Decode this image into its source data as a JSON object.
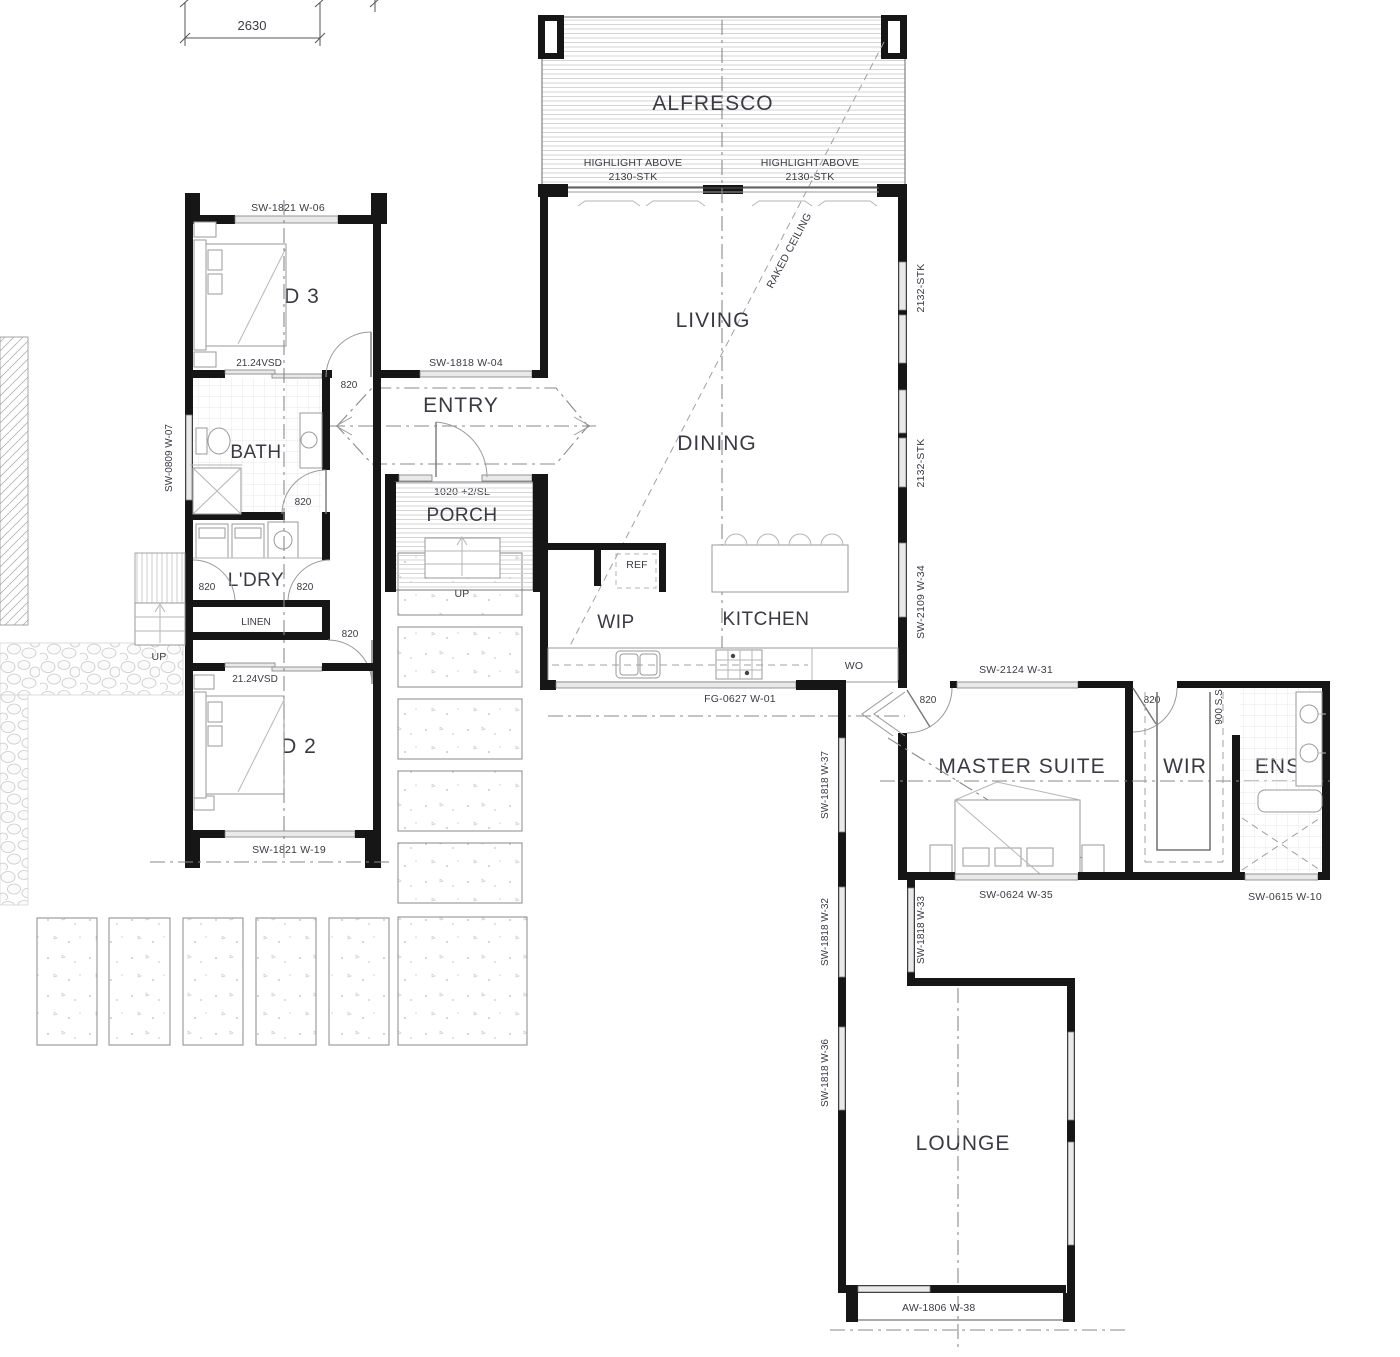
{
  "plan": {
    "dimension_top": "2630",
    "rooms": {
      "alfresco": "ALFRESCO",
      "living": "LIVING",
      "dining": "DINING",
      "kitchen": "KITCHEN",
      "wip": "WIP",
      "entry": "ENTRY",
      "porch": "PORCH",
      "bed3": "BED 3",
      "bath": "BATH",
      "ldry": "L'DRY",
      "linen": "LINEN",
      "bed2": "BED 2",
      "master_suite": "MASTER SUITE",
      "wir": "WIR",
      "ens": "ENS",
      "lounge": "LOUNGE"
    },
    "fixtures": {
      "ref": "REF",
      "wall_oven": "WO"
    },
    "annotations": {
      "highlight_above": "HIGHLIGHT ABOVE",
      "stk_2130": "2130-STK",
      "stk_2132": "2132-STK",
      "raked_ceiling": "RAKED CEILING",
      "up": "UP",
      "door_820": "820",
      "front_door": "1020 +2/SL",
      "vsd": "21.24VSD",
      "ss_900": "900 S.S"
    },
    "windows": {
      "w04": "SW-1818 W-04",
      "w06": "SW-1821 W-06",
      "w07": "SW-0809 W-07",
      "w19": "SW-1821 W-19",
      "w01": "FG-0627 W-01",
      "w34": "SW-2109 W-34",
      "w31": "SW-2124 W-31",
      "w35": "SW-0624 W-35",
      "w10": "SW-0615 W-10",
      "w37": "SW-1818 W-37",
      "w32": "SW-1818 W-32",
      "w33": "SW-1818 W-33",
      "w36": "SW-1818 W-36",
      "w38": "AW-1806 W-38"
    }
  }
}
